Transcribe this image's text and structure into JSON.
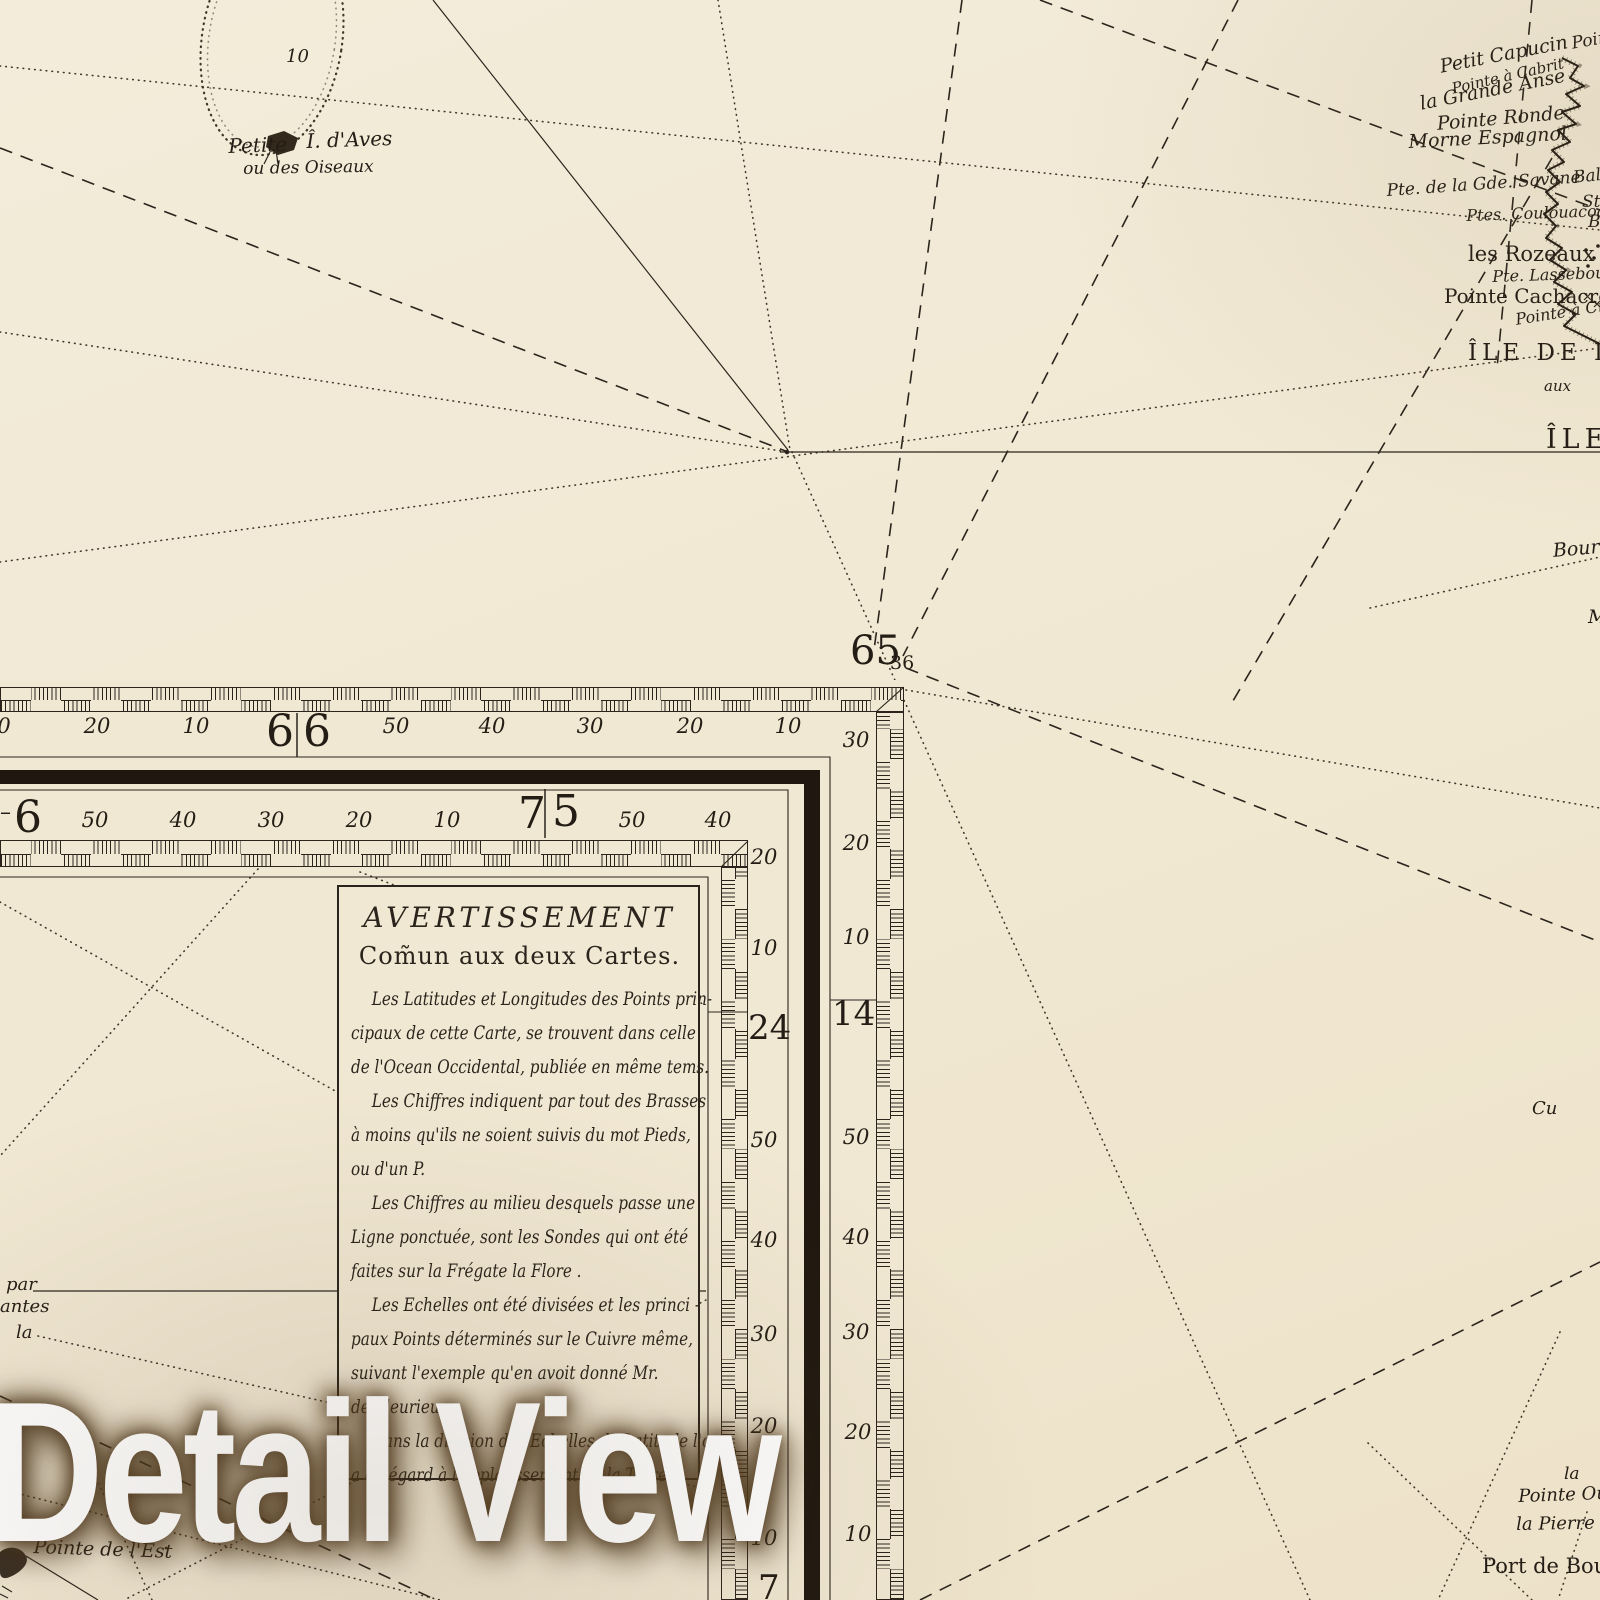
{
  "colors": {
    "paper": "#f1e8d3",
    "ink": "#2b241c",
    "band": "#201810",
    "dot": "#3f362a"
  },
  "watermark": {
    "text": "Detail View"
  },
  "notice": {
    "title": "AVERTISSEMENT",
    "subtitle": "Com̃un aux deux Cartes.",
    "lines": [
      {
        "t": "Les Latitudes et Longitudes des Points prin-",
        "ind": true
      },
      {
        "t": "cipaux de cette Carte, se trouvent dans celle",
        "ind": false
      },
      {
        "t": "de l'Ocean Occidental, publiée en même tems.",
        "ind": false
      },
      {
        "t": "Les Chiffres indiquent par tout des Brasses",
        "ind": true
      },
      {
        "t": "à moins qu'ils ne soient suivis du mot Pieds,",
        "ind": false
      },
      {
        "t": "ou d'un P.",
        "ind": false
      },
      {
        "t": "Les Chiffres au milieu desquels passe une",
        "ind": true
      },
      {
        "t": "Ligne ponctuée, sont les Sondes qui ont été",
        "ind": false
      },
      {
        "t": "faites sur la Frégate la Flore .",
        "ind": false
      },
      {
        "t": "Les Echelles ont été divisées et les princi -",
        "ind": true
      },
      {
        "t": "paux Points déterminés sur le Cuivre même,",
        "ind": false
      },
      {
        "t": "suivant l'exemple qu'en avoit donné Mr.",
        "ind": false
      },
      {
        "t": "de Fleurieu .",
        "ind": false
      },
      {
        "t": "Dans la division des Echelles de Latitude l'on",
        "ind": true
      },
      {
        "t": "a eu égard à l'applatissement de la Terre .",
        "ind": false
      }
    ]
  },
  "labels": [
    {
      "t": "10",
      "x": 286,
      "y": 46,
      "s": 18,
      "c": "it"
    },
    {
      "t": "Petite",
      "x": 228,
      "y": 134,
      "s": 20,
      "c": "it",
      "r": -2
    },
    {
      "t": "Î. d'Aves",
      "x": 306,
      "y": 129,
      "s": 20,
      "c": "it",
      "r": -2
    },
    {
      "t": "ou des Oiseaux",
      "x": 243,
      "y": 159,
      "s": 17,
      "c": "it",
      "r": -1
    },
    {
      "t": "Pointe",
      "x": 1570,
      "y": 34,
      "s": 17,
      "c": "it",
      "r": -10
    },
    {
      "t": "Petit Capucin",
      "x": 1438,
      "y": 56,
      "s": 19,
      "c": "it",
      "r": -11
    },
    {
      "t": "Pointe à Cabrit",
      "x": 1450,
      "y": 80,
      "s": 15,
      "c": "it",
      "r": -13
    },
    {
      "t": "la Grande Anse",
      "x": 1418,
      "y": 93,
      "s": 19,
      "c": "it",
      "r": -11
    },
    {
      "t": "Pointe Ronde",
      "x": 1436,
      "y": 113,
      "s": 19,
      "c": "it",
      "r": -5
    },
    {
      "t": "Morne Espagnol",
      "x": 1408,
      "y": 131,
      "s": 19,
      "c": "it",
      "r": -3
    },
    {
      "t": "Baleine",
      "x": 1572,
      "y": 168,
      "s": 17,
      "c": "it",
      "r": -6
    },
    {
      "t": "Pte. de la Gde. Savane",
      "x": 1386,
      "y": 181,
      "s": 17,
      "c": "it",
      "r": -4
    },
    {
      "t": "St. J",
      "x": 1582,
      "y": 192,
      "s": 17,
      "c": "it"
    },
    {
      "t": "Ptes. Coulouacoa",
      "x": 1466,
      "y": 206,
      "s": 16,
      "c": "it",
      "r": -2
    },
    {
      "t": "Bo",
      "x": 1588,
      "y": 212,
      "s": 17,
      "c": "it"
    },
    {
      "t": "les Rozeaux",
      "x": 1468,
      "y": 242,
      "s": 21,
      "c": "rm"
    },
    {
      "t": "Pte. Lassebouli",
      "x": 1492,
      "y": 267,
      "s": 16,
      "c": "it",
      "r": -2
    },
    {
      "t": "Pointe Cachacrou",
      "x": 1444,
      "y": 284,
      "s": 20,
      "c": "rm"
    },
    {
      "t": "Pointe à Crabe",
      "x": 1514,
      "y": 310,
      "s": 16,
      "c": "it",
      "r": -9
    },
    {
      "t": "ÎLE DE LA",
      "x": 1468,
      "y": 340,
      "s": 23,
      "c": "sp"
    },
    {
      "t": "aux",
      "x": 1544,
      "y": 377,
      "s": 15,
      "c": "it"
    },
    {
      "t": "ÎLE",
      "x": 1546,
      "y": 424,
      "s": 27,
      "c": "sp"
    },
    {
      "t": "Bourg",
      "x": 1552,
      "y": 540,
      "s": 19,
      "c": "it",
      "r": -5
    },
    {
      "t": "M",
      "x": 1588,
      "y": 606,
      "s": 19,
      "c": "it"
    },
    {
      "t": "Cu",
      "x": 1532,
      "y": 1098,
      "s": 18,
      "c": "it"
    },
    {
      "t": "la",
      "x": 1564,
      "y": 1464,
      "s": 17,
      "c": "it"
    },
    {
      "t": "Pointe Ouar",
      "x": 1518,
      "y": 1486,
      "s": 18,
      "c": "it",
      "r": -2
    },
    {
      "t": "la Pierre Per",
      "x": 1516,
      "y": 1514,
      "s": 18,
      "c": "it",
      "r": -1
    },
    {
      "t": "Port de Bouca",
      "x": 1482,
      "y": 1554,
      "s": 21,
      "c": "rm"
    },
    {
      "t": "par",
      "x": 6,
      "y": 1274,
      "s": 18,
      "c": "it"
    },
    {
      "t": "antes",
      "x": 0,
      "y": 1296,
      "s": 18,
      "c": "it"
    },
    {
      "t": "la",
      "x": 16,
      "y": 1322,
      "s": 18,
      "c": "it"
    },
    {
      "t": "Pointe de l'Est",
      "x": 34,
      "y": 1536,
      "s": 19,
      "c": "it",
      "r": 2
    },
    {
      "t": "65",
      "x": 850,
      "y": 628,
      "s": 40,
      "c": "bg"
    },
    {
      "t": "36",
      "x": 890,
      "y": 652,
      "s": 19,
      "c": "rm"
    },
    {
      "t": "0",
      "x": 4,
      "y": 714,
      "s": 21,
      "c": "mn",
      "a": "c"
    },
    {
      "t": "20",
      "x": 97,
      "y": 714,
      "s": 21,
      "c": "mn",
      "a": "c"
    },
    {
      "t": "10",
      "x": 196,
      "y": 714,
      "s": 21,
      "c": "mn",
      "a": "c"
    },
    {
      "t": "6",
      "x": 266,
      "y": 706,
      "s": 44,
      "c": "bg"
    },
    {
      "t": "6",
      "x": 303,
      "y": 706,
      "s": 44,
      "c": "bg"
    },
    {
      "t": "50",
      "x": 396,
      "y": 714,
      "s": 21,
      "c": "mn",
      "a": "c"
    },
    {
      "t": "40",
      "x": 492,
      "y": 714,
      "s": 21,
      "c": "mn",
      "a": "c"
    },
    {
      "t": "30",
      "x": 590,
      "y": 714,
      "s": 21,
      "c": "mn",
      "a": "c"
    },
    {
      "t": "20",
      "x": 690,
      "y": 714,
      "s": 21,
      "c": "mn",
      "a": "c"
    },
    {
      "t": "10",
      "x": 788,
      "y": 714,
      "s": 21,
      "c": "mn",
      "a": "c"
    },
    {
      "t": "30",
      "x": 856,
      "y": 728,
      "s": 21,
      "c": "mn",
      "a": "c"
    },
    {
      "t": "20",
      "x": 856,
      "y": 831,
      "s": 21,
      "c": "mn",
      "a": "c"
    },
    {
      "t": "10",
      "x": 856,
      "y": 925,
      "s": 21,
      "c": "mn",
      "a": "c"
    },
    {
      "t": "14",
      "x": 832,
      "y": 994,
      "s": 34,
      "c": "bg"
    },
    {
      "t": "50",
      "x": 856,
      "y": 1125,
      "s": 21,
      "c": "mn",
      "a": "c"
    },
    {
      "t": "40",
      "x": 856,
      "y": 1225,
      "s": 21,
      "c": "mn",
      "a": "c"
    },
    {
      "t": "30",
      "x": 856,
      "y": 1320,
      "s": 21,
      "c": "mn",
      "a": "c"
    },
    {
      "t": "20",
      "x": 858,
      "y": 1420,
      "s": 21,
      "c": "mn",
      "a": "c"
    },
    {
      "t": "10",
      "x": 858,
      "y": 1522,
      "s": 21,
      "c": "mn",
      "a": "c"
    },
    {
      "t": "–",
      "x": 0,
      "y": 800,
      "s": 22,
      "c": "rm"
    },
    {
      "t": "6",
      "x": 14,
      "y": 792,
      "s": 44,
      "c": "bg"
    },
    {
      "t": "50",
      "x": 95,
      "y": 808,
      "s": 21,
      "c": "mn",
      "a": "c"
    },
    {
      "t": "40",
      "x": 183,
      "y": 808,
      "s": 21,
      "c": "mn",
      "a": "c"
    },
    {
      "t": "30",
      "x": 271,
      "y": 808,
      "s": 21,
      "c": "mn",
      "a": "c"
    },
    {
      "t": "20",
      "x": 359,
      "y": 808,
      "s": 21,
      "c": "mn",
      "a": "c"
    },
    {
      "t": "10",
      "x": 447,
      "y": 808,
      "s": 21,
      "c": "mn",
      "a": "c"
    },
    {
      "t": "7",
      "x": 518,
      "y": 788,
      "s": 44,
      "c": "bg"
    },
    {
      "t": "5",
      "x": 552,
      "y": 786,
      "s": 44,
      "c": "bg"
    },
    {
      "t": "50",
      "x": 632,
      "y": 808,
      "s": 21,
      "c": "mn",
      "a": "c"
    },
    {
      "t": "40",
      "x": 718,
      "y": 808,
      "s": 21,
      "c": "mn",
      "a": "c"
    },
    {
      "t": "20",
      "x": 764,
      "y": 845,
      "s": 21,
      "c": "mn",
      "a": "c"
    },
    {
      "t": "10",
      "x": 764,
      "y": 936,
      "s": 21,
      "c": "mn",
      "a": "c"
    },
    {
      "t": "24",
      "x": 748,
      "y": 1008,
      "s": 34,
      "c": "bg"
    },
    {
      "t": "50",
      "x": 764,
      "y": 1128,
      "s": 21,
      "c": "mn",
      "a": "c"
    },
    {
      "t": "40",
      "x": 764,
      "y": 1228,
      "s": 21,
      "c": "mn",
      "a": "c"
    },
    {
      "t": "30",
      "x": 764,
      "y": 1322,
      "s": 21,
      "c": "mn",
      "a": "c"
    },
    {
      "t": "20",
      "x": 764,
      "y": 1414,
      "s": 21,
      "c": "mn",
      "a": "c"
    },
    {
      "t": "10",
      "x": 764,
      "y": 1526,
      "s": 21,
      "c": "mn",
      "a": "c"
    },
    {
      "t": "7",
      "x": 758,
      "y": 1568,
      "s": 34,
      "c": "bg"
    }
  ]
}
